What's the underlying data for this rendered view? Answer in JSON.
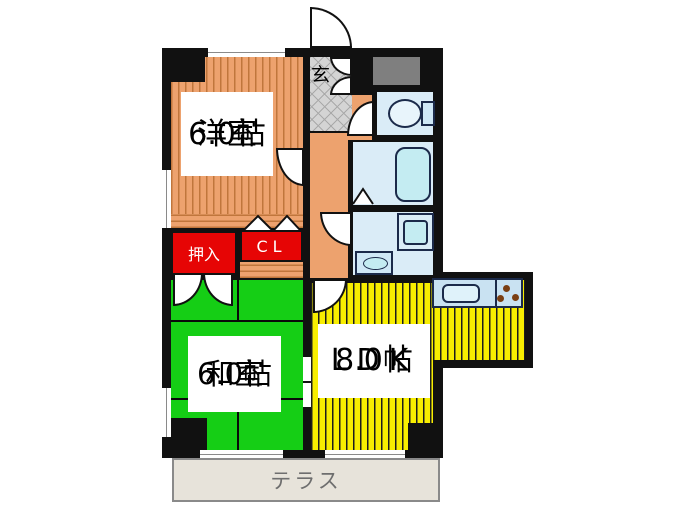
{
  "rooms": {
    "western": {
      "name": "洋室",
      "size": "6.0帖"
    },
    "japanese": {
      "name": "和室",
      "size": "6.0帖"
    },
    "ldk": {
      "name": "LDK",
      "size": "8.0帖"
    }
  },
  "entrance": {
    "label": "玄"
  },
  "closets": {
    "oshiire": "押入",
    "cl": "CL"
  },
  "terrace": {
    "label": "テラス"
  },
  "colors": {
    "wall_black": "#111111",
    "wood_floor": "#EDA26E",
    "wood_stripe": "#C0763C",
    "tatami_green": "#15CE15",
    "ldk_yellow": "#F8EE00",
    "closet_red": "#E60505",
    "water_blue": "#DAECF7",
    "fixture_blue": "#C4ECF2",
    "fixture_border": "#1B2A4A",
    "tile_gray": "#D4D4D4",
    "meter_gray": "#7F7F7F",
    "terrace_beige": "#E7E3DA"
  }
}
